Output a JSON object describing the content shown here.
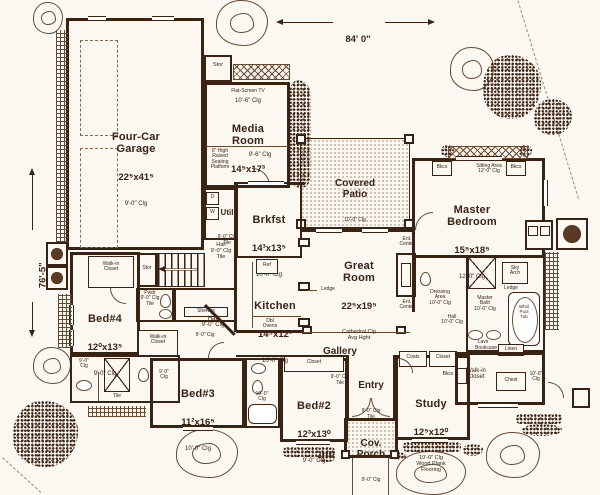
{
  "plan_title": "First Floor Plan",
  "dimensions": {
    "width": "84' 0\"",
    "height": "76'-5\""
  },
  "labels": {
    "garage_name": "Four-Car\nGarage",
    "garage_size": "22⁵x41⁵",
    "garage_clg": "9'-0\" Clg",
    "media_tv": "Flat-Screen TV",
    "media_clg1": "10'-6\" Clg",
    "media_name": "Media\nRoom",
    "media_size": "14⁵x17³",
    "media_clg2": "9'-6\" Clg",
    "media_platform": "6\" High\nRaised\nSeating\nPlatform",
    "stor1": "Stor",
    "stor2": "Stor",
    "util_name": "Util",
    "util_clg": "9'-0\" Clg\nTile",
    "dryer": "D",
    "washer": "W",
    "patio_name": "Covered\nPatio",
    "patio_clg": "10'-0\" Clg",
    "brkfst_name": "Brkfst",
    "brkfst_size": "14³x13⁵",
    "brkfst_clg": "10'-0\" Clg",
    "kitchen_name": "Kitchen",
    "kitchen_size": "14⁵x12³",
    "kitchen_clg": "10'-0\" Clg",
    "ref": "Ref",
    "dbl_ovens": "Dbl\nOvens",
    "great_name": "Great\nRoom",
    "great_size": "22⁵x19⁵",
    "great_clg": "Cathedral Clg\nAvg Hght",
    "ledge1": "Ledge",
    "ledge2": "Ledge",
    "ent_center1": "Ent.\nCenter",
    "ent_center2": "Ent.\nCenter",
    "master_name": "Master\nBedroom",
    "master_size": "15⁵x18⁵",
    "master_clg": "12'-0\" Clg",
    "sitting": "Sitting Area\n12'-0\" Clg",
    "bkcs1": "Bkcs",
    "bkcs2": "Bkcs",
    "bkcs3": "Bkcs",
    "hall_tile": "Hall\n9'-0\" Clg\nTile",
    "hall_mid": "Hall\n9'-0\" Clg",
    "hall_master": "Hall\n10'-0\" Clg",
    "pwdr": "Pwdr\n9'-0\" Clg\nTile",
    "pantry_name": "Pantry",
    "pantry_clg": "9'-0\" Clg",
    "shelves": "Shelves",
    "bed4_name": "Bed#4",
    "bed4_size": "12⁰x13⁵",
    "bed4_clg": "9'-0\" Clg",
    "wic_bed4": "Walk-in\nCloset",
    "wic_bed3": "Walk-in\nCloset",
    "bath_left_clg1": "9'-0\"\nClg",
    "bath_left_clg2": "9'-0\"\nClg",
    "tile1": "Tile",
    "bed3_name": "Bed#3",
    "bed3_size": "11²x16⁵",
    "bed3_clg": "10'-0\" Clg",
    "bath23_clg": "10'-0\"\nClg",
    "bed2_name": "Bed#2",
    "bed2_size": "12³x13⁰",
    "bed2_clg": "9'-0\" Clg",
    "closet_bed2": "Closet",
    "gallery_name": "Gallery",
    "gallery_clg": "9'-0\" Clg\nTile",
    "entry_name": "Entry",
    "entry_clg": "9'-0\" Clg\nTile",
    "porch_name": "Cov.\nPorch",
    "porch_clg": "9'-0\" Clg",
    "study_name": "Study",
    "study_size": "12⁵x12⁰",
    "study_notes": "10'-0\" Clg\nWood Plank\nFlooring",
    "coats": "Coats",
    "closet_study": "Closet",
    "mbath": "Master\nBath\n10'-0\" Clg",
    "dressing": "Dressing\nArea\n10'-0\" Clg",
    "sky_arch": "Sky\nArch",
    "tub_label": "Whirl\nPool\nTub",
    "lavs": "Lavs",
    "linen": "Linen",
    "wic_master": "Walk-in\nCloset",
    "wic_master_clg": "10'-0\"\nClg",
    "chest": "Chest",
    "bookcase": "Bookcase"
  }
}
